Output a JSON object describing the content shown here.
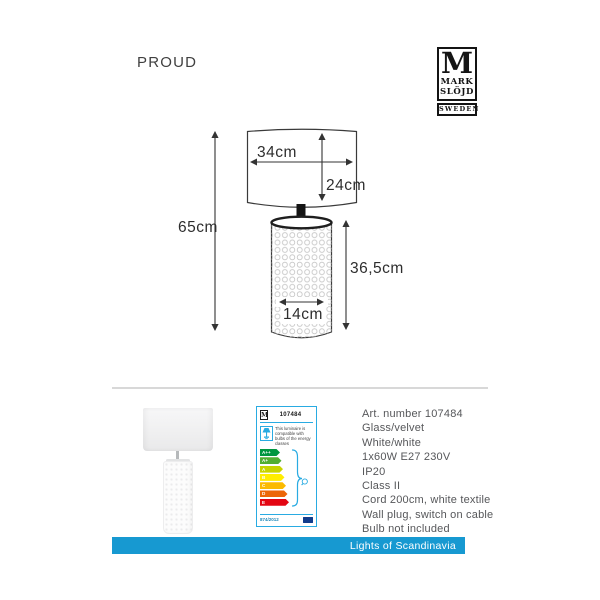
{
  "header": {
    "title": "PROUD",
    "logo": {
      "monogram": "M",
      "line1": "MARK",
      "line2": "SLÖJD",
      "line3": "SWEDEN"
    }
  },
  "diagram": {
    "total_height": "65cm",
    "shade_width": "34cm",
    "shade_height": "24cm",
    "base_height": "36,5cm",
    "base_width": "14cm"
  },
  "energy_label": {
    "logo_monogram": "M",
    "art_number": "107484",
    "compat_text": "This luminaire is compatible with bulbs of the energy classes",
    "classes": [
      {
        "label": "A++",
        "color": "#009640",
        "width": 20
      },
      {
        "label": "A+",
        "color": "#52ae32",
        "width": 21.5
      },
      {
        "label": "A",
        "color": "#c8d400",
        "width": 23
      },
      {
        "label": "B",
        "color": "#ffed00",
        "width": 24.5
      },
      {
        "label": "C",
        "color": "#fbba00",
        "width": 26
      },
      {
        "label": "D",
        "color": "#ec6608",
        "width": 27.5
      },
      {
        "label": "E",
        "color": "#e30613",
        "width": 29
      }
    ],
    "regulation": "874/2012",
    "accent": "#29abe2",
    "eu_flag_color": "#123c8c"
  },
  "details": {
    "lines": [
      "Art. number 107484",
      "Glass/velvet",
      "White/white",
      "1x60W E27 230V",
      "IP20",
      "Class II",
      "Cord 200cm, white textile",
      "Wall plug, switch on cable",
      "Bulb not included"
    ]
  },
  "footer": {
    "brand_text": "Lights of Scandinavia",
    "bar_color": "#1799d1"
  }
}
